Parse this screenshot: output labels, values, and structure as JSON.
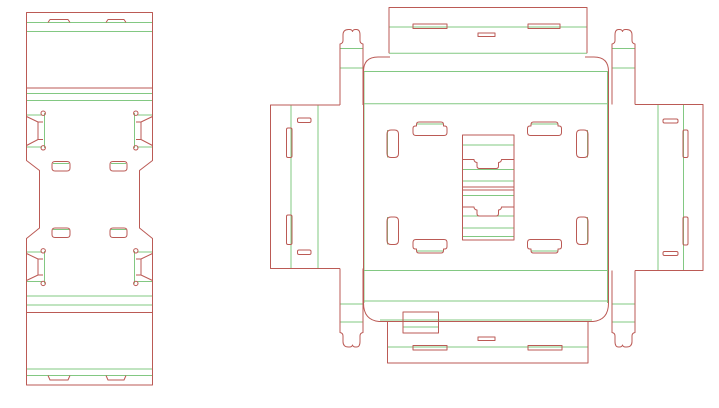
{
  "document": {
    "kind": "packaging-dieline-cad-drawing",
    "canvas": {
      "width": 719,
      "height": 408,
      "background": "#ffffff"
    }
  },
  "colors": {
    "cut": "#bb5a55",
    "crease": "#82c882"
  },
  "drawing": {
    "blanks": [
      {
        "id": "tall-carton-blank",
        "layers": {
          "crease": [
            "M26.5,22.5 H152.5",
            "M26.5,31.5 H152.5",
            "M26.5,93.5 H152.5",
            "M26.5,100.5 H152.5",
            "M26.5,296 H152.5",
            "M26.5,305 H152.5",
            "M26.5,369 H152.5",
            "M26.5,375.5 H152.5",
            "M27,115 H42",
            "M27,147 H42",
            "M44.5,113 V148",
            "M137,115 H152",
            "M137,147 H152",
            "M134.5,113 V148",
            "M27,252 H42",
            "M27,281.5 H42",
            "M44.5,251 V283.5",
            "M137,252 H152",
            "M137,281.5 H152",
            "M134.5,251 V283.5",
            "M53,163.5 H69",
            "M111,163.5 H126",
            "M53,229.5 H69",
            "M111,229.5 H126"
          ],
          "cut": [
            "M26.5,12.5 H152.5 V160.5 L139.5,170.5 V228 L152.5,238.5 V385 H26.5 V238.5 L39.5,228 V170.5 L26.5,160.5 Z",
            "M48,22.5 L50,19.5 H68 L70,22.5",
            "M106,22.5 L108,19.5 H124 L126,22.5",
            "M26.5,88 H152.5",
            "M26.5,312.5 H152.5",
            "M48,375.5 L50,380 H68 L70,375.5",
            "M106,375.5 L108,380 H124 L126,375.5",
            "M26.5,116.5 L38,122 H43 M26.5,145.5 L38,139.5 H43 M38,122 V139.5",
            "M152.5,116.5 L141,122 H136 M152.5,145.5 L141,139.5 H136 M141,122 V139.5",
            "M26.5,253.5 L38,259 H43 M26.5,280.5 L38,275 H43 M38,259 V275",
            "M152.5,253.5 L141,259 H136 M152.5,280.5 L141,275 H136 M141,259 V275",
            "M41,113.2 a2.2,2.2 0 1 0 4.4,0 a2.2,2.2 0 1 0 -4.4,0",
            "M41,147.8 a2.2,2.2 0 1 0 4.4,0 a2.2,2.2 0 1 0 -4.4,0",
            "M133.6,113.2 a2.2,2.2 0 1 0 4.4,0 a2.2,2.2 0 1 0 -4.4,0",
            "M133.6,147.8 a2.2,2.2 0 1 0 4.4,0 a2.2,2.2 0 1 0 -4.4,0",
            "M41,250.8 a2.2,2.2 0 1 0 4.4,0 a2.2,2.2 0 1 0 -4.4,0",
            "M41,283.4 a2.2,2.2 0 1 0 4.4,0 a2.2,2.2 0 1 0 -4.4,0",
            "M133.6,250.8 a2.2,2.2 0 1 0 4.4,0 a2.2,2.2 0 1 0 -4.4,0",
            "M133.6,283.4 a2.2,2.2 0 1 0 4.4,0 a2.2,2.2 0 1 0 -4.4,0",
            "M55,161.5 H67 Q70,161.5 70,164.5 V168 Q70,171 67,171 H55 Q52,171 52,168 V164.5 Q52,161.5 55,161.5 Z",
            "M113,161.5 H124 Q127,161.5 127,164.5 V168 Q127,171 124,171 H113 Q110,171 110,168 V164.5 Q110,161.5 113,161.5 Z",
            "M55,228 H67 Q70,228 70,231 V234.5 Q70,237.5 67,237.5 H55 Q52,237.5 52,234.5 V231 Q52,228 55,228 Z",
            "M113,228 H124 Q127,228 127,231 V234.5 Q127,237.5 124,237.5 H113 Q110,237.5 110,234.5 V231 Q110,228 113,228 Z"
          ]
        }
      },
      {
        "id": "cross-carton-blank",
        "layers": {
          "crease": [
            "M389,27 H587",
            "M389,53.3 H587",
            "M364,71.5 H608",
            "M364,103.8 H608",
            "M364,270.5 H608",
            "M364,301 H608",
            "M380,320 H592",
            "M388,347 H588",
            "M340,48.5 H363",
            "M612,48.5 H635",
            "M340,68 H363",
            "M612,68 H635",
            "M340,304 H363",
            "M612,304 H635",
            "M340,322 H363",
            "M612,322 H635",
            "M364,71.5 V303",
            "M607.5,71.5 V303",
            "M291,105 V268.5",
            "M318,105 V268.5",
            "M658,104.5 V270.5",
            "M683.5,104.5 V270.5",
            "M387.5,130 V157.5",
            "M387.5,217 V244.5",
            "M587.5,130 V157.5",
            "M587.5,217 V244.5",
            "M417,124 H443.5",
            "M531.5,124 H558",
            "M417,251 H443.5",
            "M531.5,251 H558",
            "M462.5,145 H514",
            "M462.5,169.5 H514",
            "M462.5,181 H514",
            "M462.5,195.5 H514",
            "M462.5,216 H514",
            "M462.5,228 H514",
            "M462.5,236.5 H514",
            "M403,327 H438.5"
          ],
          "cut": [
            "M389,53.3 V7.5 H587 V53.3",
            "M413,24 H447 V28.5 H413 Z",
            "M528,24 H560 V28.5 H528 Z",
            "M478,33 H495 V36.5 H478 Z",
            "M390,57 H378 Q363.5,57 363.5,71.5 V303 Q363.5,320 379,321.5 H593 Q608.5,320 608.5,303 V71.5 Q608.5,57 594,57 H585",
            "M387.5,321.5 V363 H588 V321.5",
            "M413,345.5 H447 V350 H413 Z",
            "M528,345.5 H562 V350 H528 Z",
            "M478,337 H495 V340.5 H478 Z",
            "M403,312 H438.5 V333 H403 Z",
            "M340,105 H270.5 V268.5 H340",
            "M635,104.5 H703 V270.5 H635",
            "M340,105 V44 Q343,43.5 343,40.5 V35 Q343,29.5 348.5,29.5 H349.5 Q352,29.5 352.5,31.5 Q353,29.5 355.5,29.5 H356.5 Q360,29.5 360,35 V40.5 Q360,43.5 363,44 V105",
            "M635,104.5 V44 Q632,43.5 632,40.5 V35 Q632,29.5 626.5,29.5 H625.5 Q623,29.5 622.5,31.5 Q622,29.5 619.5,29.5 H618.5 Q615,29.5 615,35 V40.5 Q615,43.5 612,44 V104.5",
            "M340,268.5 V332.5 Q343,333 343,336 V341.5 Q343,347 348.5,347 H349.5 Q352,347 352.5,345 Q353,347 355.5,347 H356.5 Q360,347 360,341.5 V336 Q360,333 363,332.5 V268.5",
            "M635,270.5 V332.5 Q632,333 632,336 V341.5 Q632,347 626.5,347 H625.5 Q623,347 622.5,345 Q622,347 619.5,347 H618.5 Q615,347 615,341.5 V336 Q615,333 612,332.5 V270.5",
            "M299,118 H309.5 Q311,118 311,119.5 V121 Q311,122.5 309.5,122.5 H299 Q297.5,122.5 297.5,121 V119.5 Q297.5,118 299,118 Z",
            "M299,250 H309.5 Q311,250 311,251.5 V253 Q311,254.5 309.5,254.5 H299 Q297.5,254.5 297.5,253 V251.5 Q297.5,250 299,250 Z",
            "M288,128 H290.5 Q292,128 292,129.5 V156 Q292,157.5 290.5,157.5 H288 Q286.5,157.5 286.5,156 V129.5 Q286.5,128 288,128 Z",
            "M288,215 H290.5 Q292,215 292,216.5 V243 Q292,244.5 290.5,244.5 H288 Q286.5,244.5 286.5,243 V216.5 Q286.5,215 288,215 Z",
            "M664.5,119 H676.5 Q678,119 678,120.5 V121.5 Q678,123 676.5,123 H664.5 Q663,123 663,121.5 V120.5 Q663,119 664.5,119 Z",
            "M664.5,251.5 H676.5 Q678,251.5 678,253 V254 Q678,255.5 676.5,255.5 H664.5 Q663,255.5 663,254 V253 Q663,251.5 664.5,251.5 Z",
            "M684.5,130 H686.5 Q688,130 688,131.5 V156 Q688,157.5 686.5,157.5 H684.5 Q683,157.5 683,156 V131.5 Q683,130 684.5,130 Z",
            "M684.5,217 H686.5 Q688,217 688,218.5 V243.5 Q688,245 686.5,245 H684.5 Q683,245 683,243.5 V218.5 Q683,217 684.5,217 Z",
            "M391,130 H394.5 Q398.5,130 398.5,134 V153.5 Q398.5,157.5 394.5,157.5 H391 Q387,157.5 387,153.5 V134 Q387,130 391,130 Z",
            "M391,217 H394.5 Q398.5,217 398.5,221 V240.5 Q398.5,244.5 394.5,244.5 H391 Q387,244.5 387,240.5 V221 Q387,217 391,217 Z",
            "M580.5,130 H584 Q588,130 588,134 V153.5 Q588,157.5 584,157.5 H580.5 Q576.5,157.5 576.5,153.5 V134 Q576.5,130 580.5,130 Z",
            "M580.5,217 H584 Q588,217 588,221 V240.5 Q588,244.5 584,244.5 H580.5 Q576.5,244.5 576.5,240.5 V221 Q576.5,217 580.5,217 Z",
            "M443.5,126 V124.5 Q443.5,122 441,122 H419 Q416.5,122 416.5,124.5 V126 H415.5 Q413,126 413,128.5 V132.5 Q413,135.5 416,135.5 H444 Q447,135.5 447,132.5 V128.5 Q447,126 444.5,126 Z",
            "M558,126 V124.5 Q558,122 555.5,122 H533.5 Q531,122 531,124.5 V126 H530 Q527.5,126 527.5,128.5 V132.5 Q527.5,135.5 530.5,135.5 H558.5 Q561.5,135.5 561.5,132.5 V128.5 Q561.5,126 559,126 Z",
            "M443.5,249 V250.5 Q443.5,253 441,253 H419 Q416.5,253 416.5,250.5 V249 H415.5 Q413,249 413,246.5 V242.5 Q413,239.5 416,239.5 H444 Q447,239.5 447,242.5 V246.5 Q447,249 444.5,249 Z",
            "M558,249 V250.5 Q558,253 555.5,253 H533.5 Q531,253 531,250.5 V249 H530 Q527.5,249 527.5,246.5 V242.5 Q527.5,239.5 530.5,239.5 H558.5 Q561.5,239.5 561.5,242.5 V246.5 Q561.5,249 559,249 Z",
            "M462.5,135 H514 V240 H462.5 Z",
            "M462.5,187 H514",
            "M462.5,190 H514",
            "M462.5,159.5 H474 A3,3 0 0 0 477,162.5 V166 Q477,168.5 479.5,168.5 H496 Q498.5,168.5 498.5,166 V162.5 A3,3 0 0 0 501.5,159.5 H514",
            "M462.5,207 H474 A3,3 0 0 0 477,210 V213.5 Q477,216 479.5,216 H496 Q498.5,216 498.5,213.5 V210 A3,3 0 0 0 501.5,207 H514"
          ]
        }
      }
    ]
  }
}
